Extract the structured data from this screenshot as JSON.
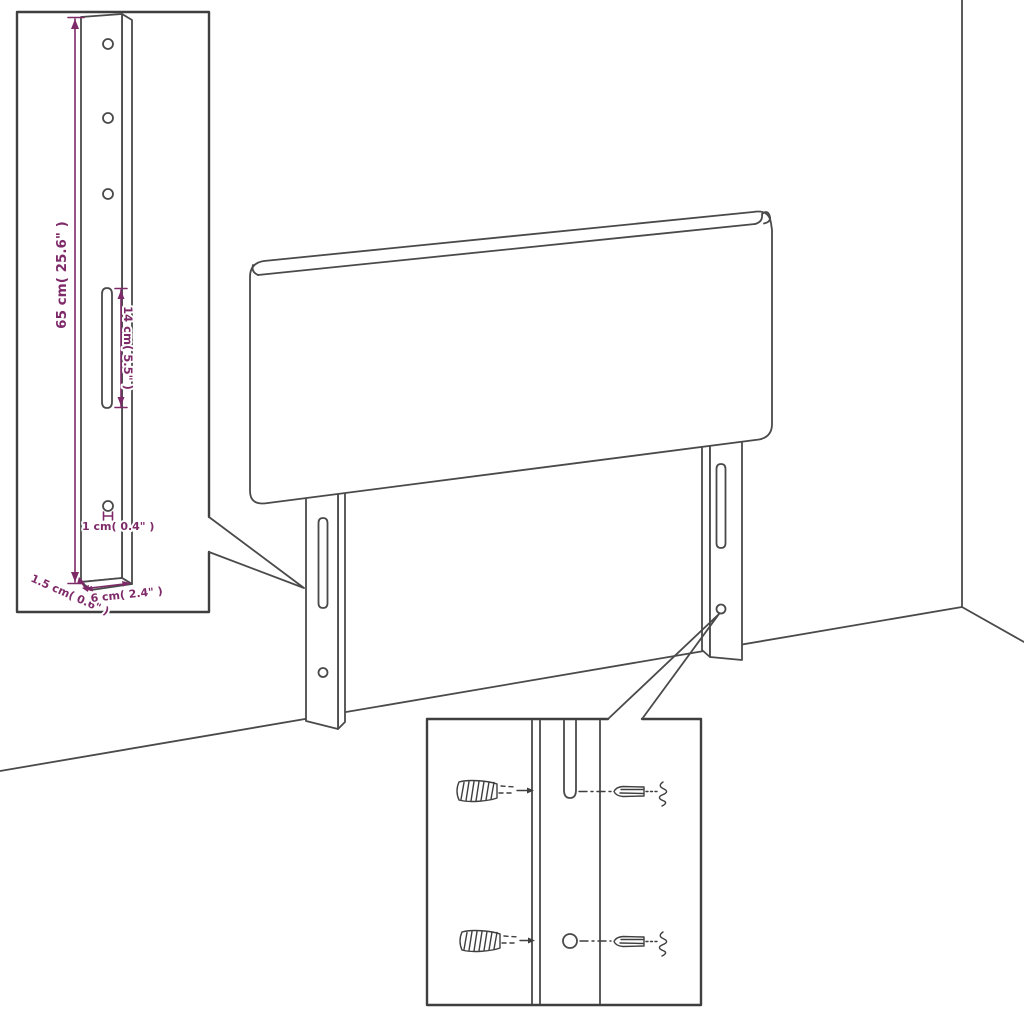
{
  "diagram": {
    "colors": {
      "background": "#ffffff",
      "line": "#4a4a4a",
      "dimension_text": "#7e2a69"
    },
    "scene": {
      "subject": "headboard-with-mounting-legs-in-room-corner",
      "bracket_inset": {
        "dims": {
          "height": "65 cm( 25.6\" )",
          "slot_length": "14 cm( 5.5\" )",
          "hole": "1 cm( 0.4\" )",
          "thickness": "1.5 cm( 0.6\" )",
          "width": "6 cm( 2.4\" )"
        }
      },
      "hardware_inset": {
        "parts": [
          "wall-plug",
          "screw"
        ]
      }
    }
  }
}
